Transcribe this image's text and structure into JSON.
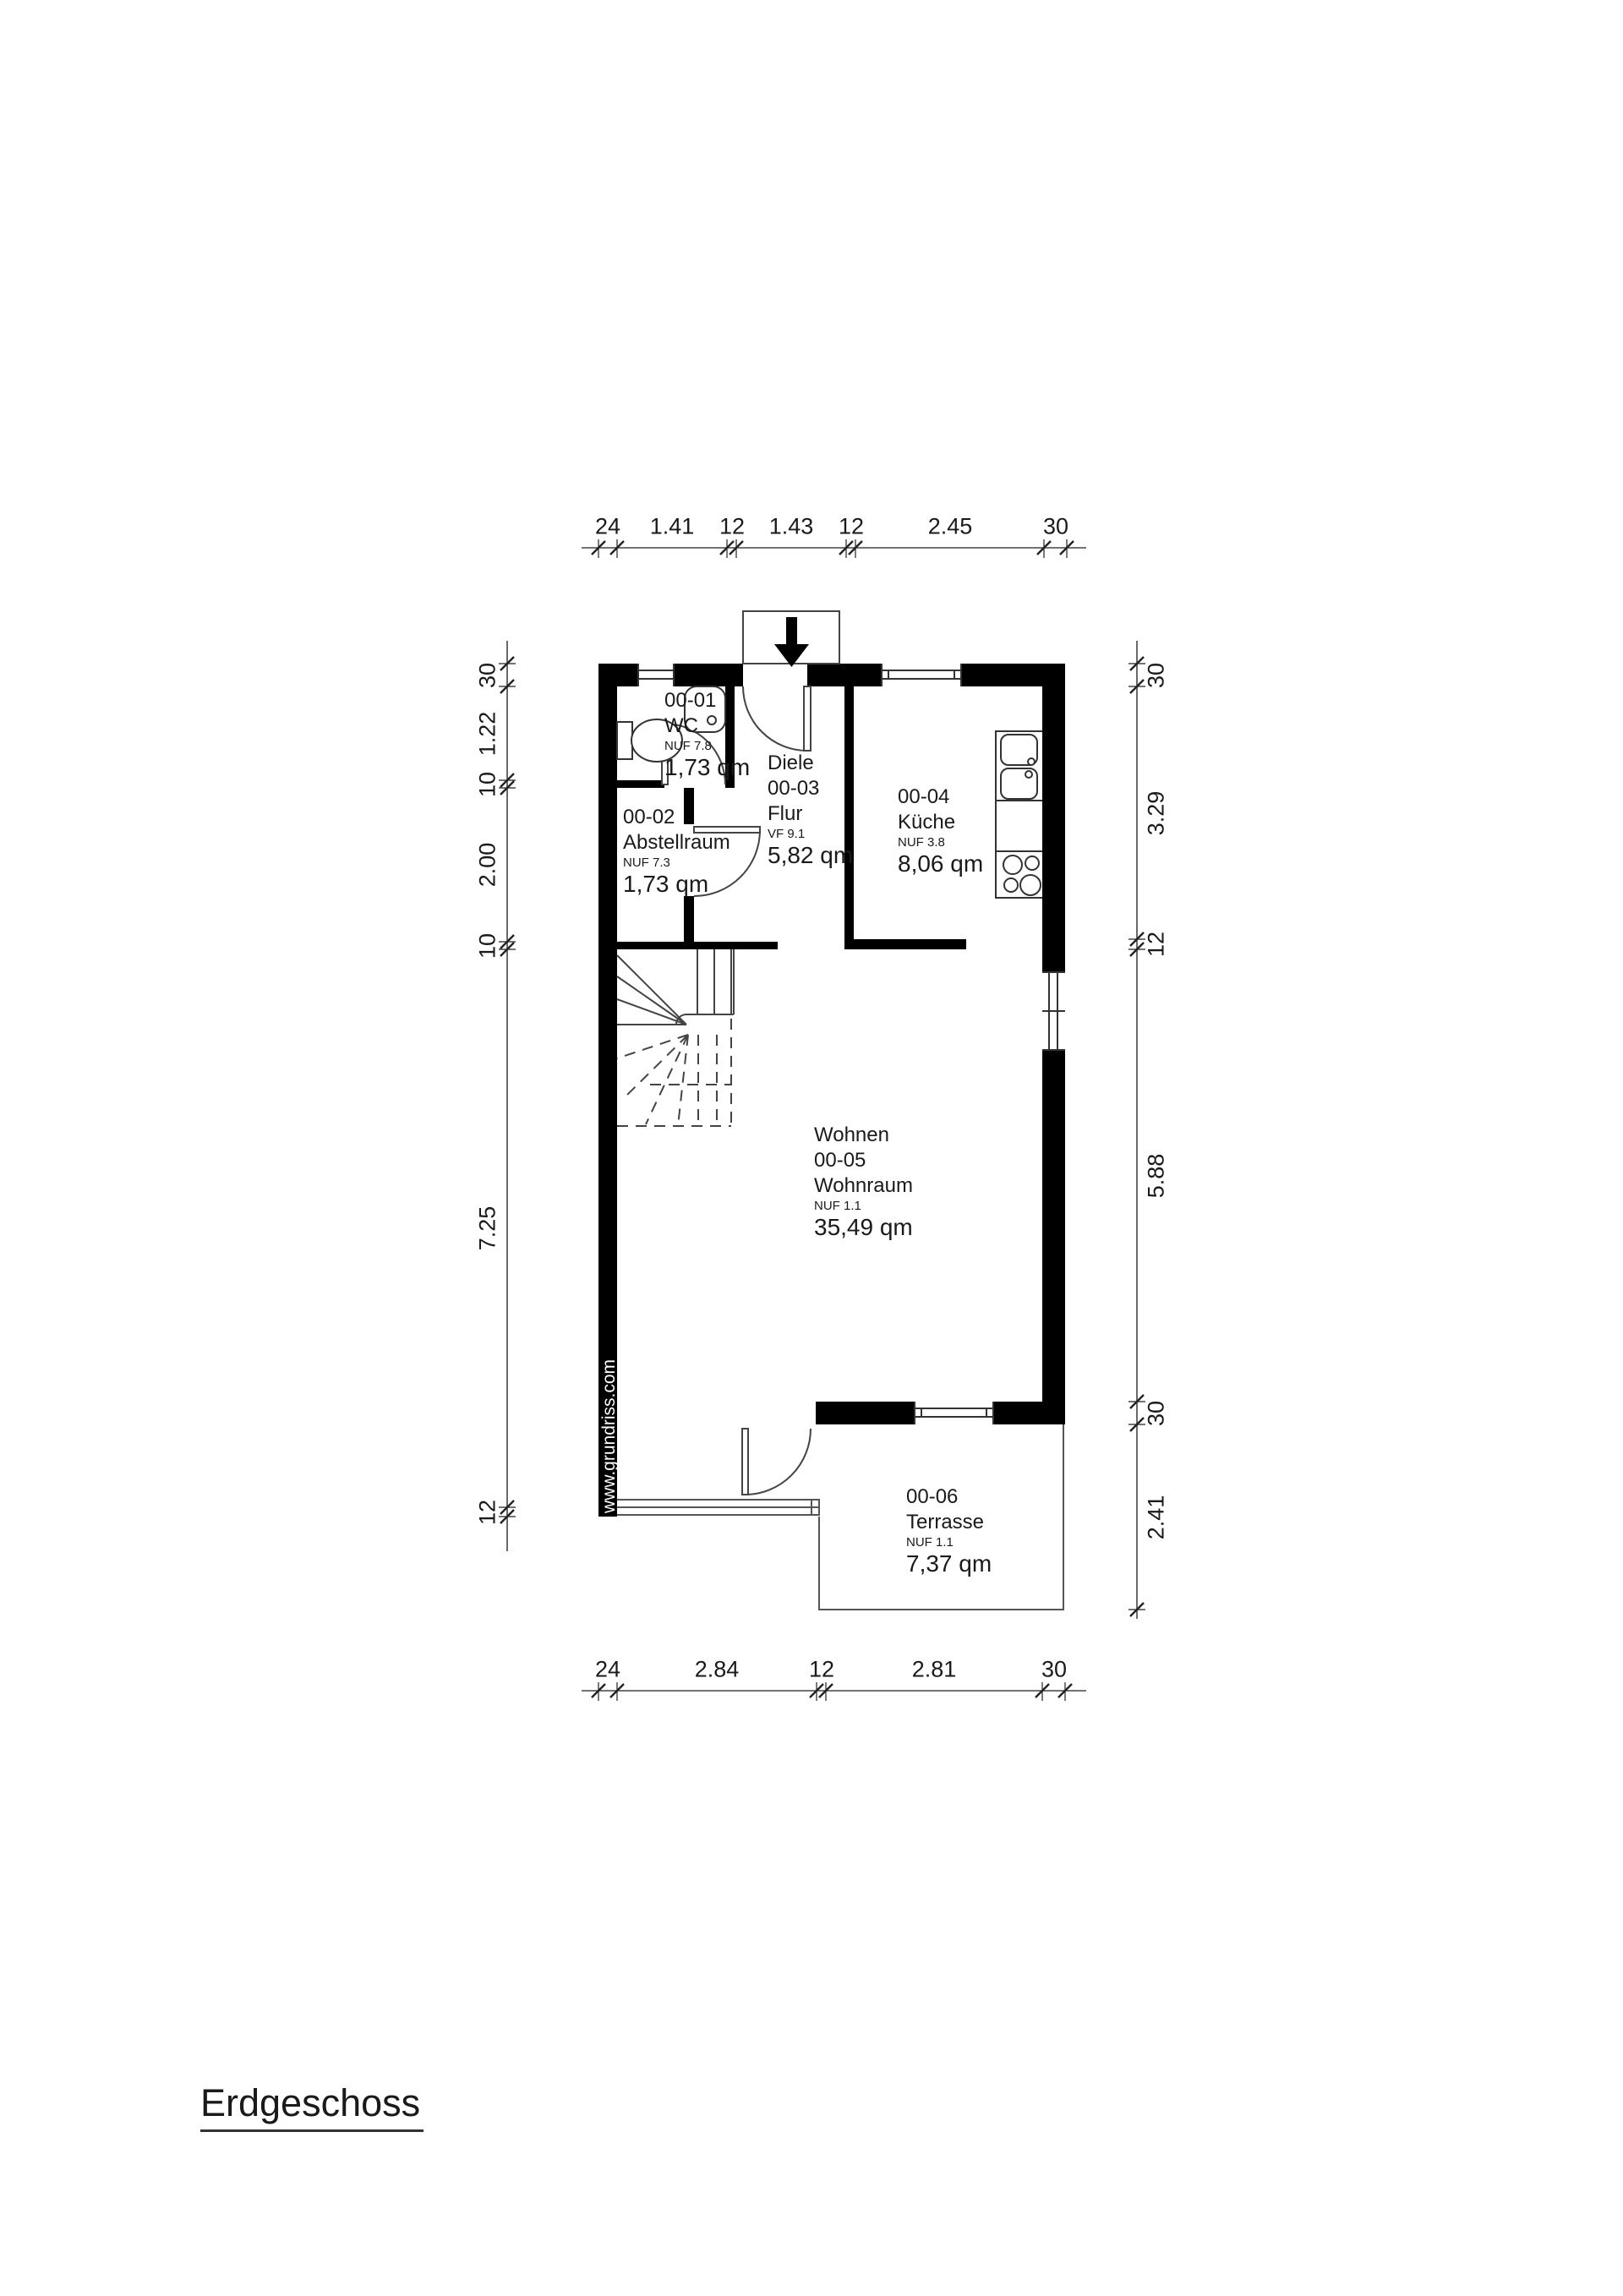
{
  "title": "Erdgeschoss",
  "watermark": "www.grundriss.com",
  "rooms": {
    "wc": {
      "code": "00-01",
      "name": "WC",
      "nuf": "NUF 7.8",
      "area": "1,73 qm"
    },
    "abstellraum": {
      "code": "00-02",
      "name": "Abstellraum",
      "nuf": "NUF 7.3",
      "area": "1,73 qm"
    },
    "diele": {
      "title": "Diele",
      "code": "00-03",
      "name": "Flur",
      "nuf": "VF 9.1",
      "area": "5,82 qm"
    },
    "kueche": {
      "code": "00-04",
      "name": "Küche",
      "nuf": "NUF 3.8",
      "area": "8,06 qm"
    },
    "wohnen": {
      "title": "Wohnen",
      "code": "00-05",
      "name": "Wohnraum",
      "nuf": "NUF 1.1",
      "area": "35,49 qm"
    },
    "terrasse": {
      "code": "00-06",
      "name": "Terrasse",
      "nuf": "NUF 1.1",
      "area": "7,37 qm"
    }
  },
  "dimensions": {
    "top": {
      "values": [
        "24",
        "1.41",
        "12",
        "1.43",
        "12",
        "2.45",
        "30"
      ]
    },
    "bottom": {
      "values": [
        "24",
        "2.84",
        "12",
        "2.81",
        "30"
      ]
    },
    "left": {
      "values": [
        "30",
        "1.22",
        "10",
        "2.00",
        "10",
        "7.25",
        "12"
      ]
    },
    "right": {
      "values": [
        "30",
        "3.29",
        "12",
        "5.88",
        "30",
        "2.41"
      ]
    }
  },
  "colors": {
    "wall": "#000000",
    "line": "#333333",
    "background": "#ffffff"
  }
}
